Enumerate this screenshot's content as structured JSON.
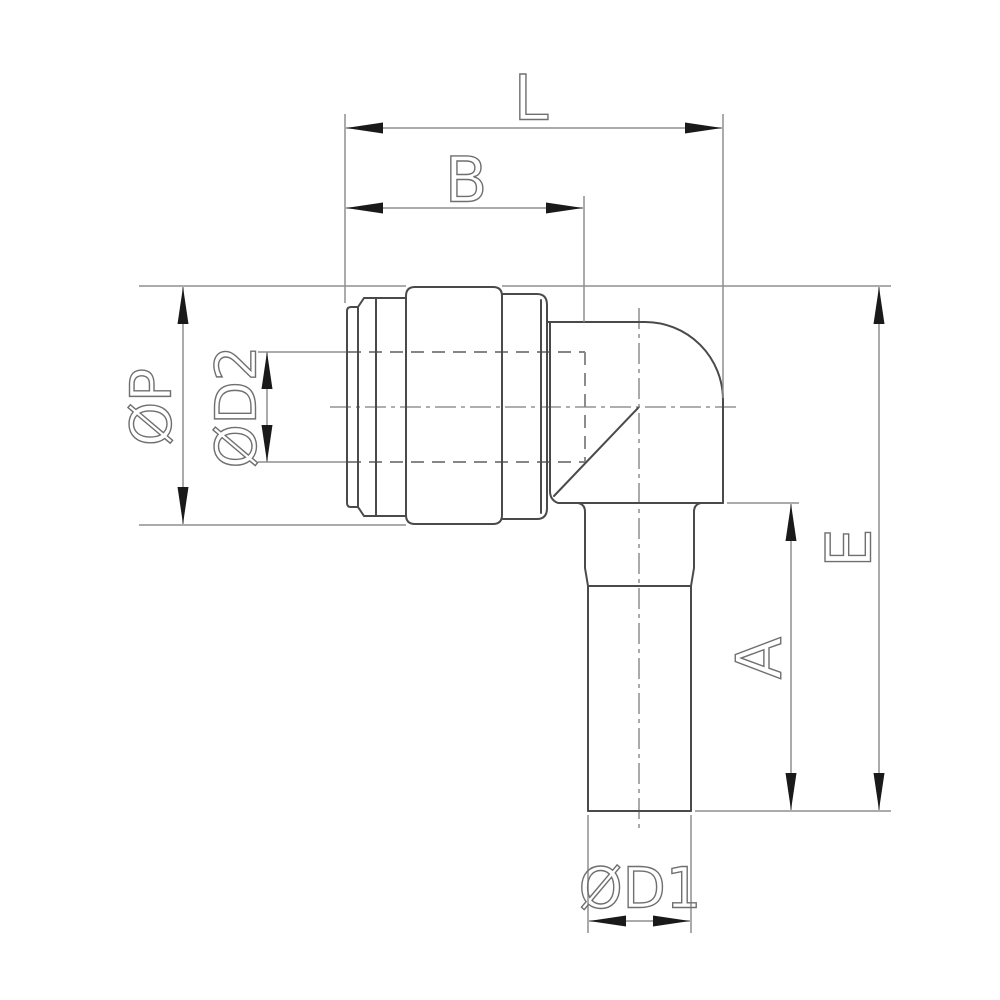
{
  "drawing": {
    "background": "#ffffff",
    "line_colors": {
      "object_outline": "#4a4a4a",
      "dimension_lines": "#8f8f8f",
      "hidden_lines": "#868686",
      "centerlines": "#7d7d7d",
      "arrowheads": "#1a1a1a",
      "label_text": "#6f6f6f"
    },
    "dimensions": {
      "top_outer": {
        "label": "L"
      },
      "top_inner": {
        "label": "B"
      },
      "left_outer": {
        "label": "ØP"
      },
      "left_inner": {
        "label": "ØD2"
      },
      "right_outer": {
        "label": "E"
      },
      "right_inner": {
        "label": "A"
      },
      "bottom": {
        "label": "ØD1"
      }
    }
  }
}
